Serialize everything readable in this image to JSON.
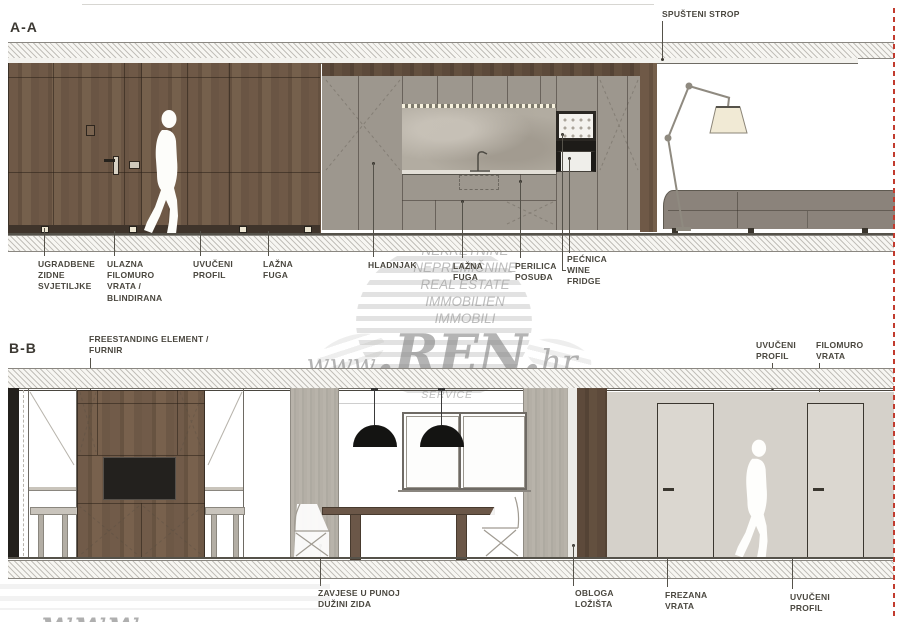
{
  "section_aa": {
    "title": "A-A",
    "ceiling_label": "SPUŠTENI STROP",
    "labels": {
      "l1": "UGRADBENE\nZIDNE\nSVJETILJKE",
      "l2": "ULAZNA\nFILOMURO\nVRATA /\nBLINDIRANA",
      "l3": "UVUČENI\nPROFIL",
      "l4": "LAŽNA\nFUGA",
      "l5": "HLADNJAK",
      "l6": "LAŽNA\nFUGA",
      "l7": "PERILICA\nPOSUĐA",
      "l8": "PEĆNICA\nWINE\nFRIDGE"
    }
  },
  "section_bb": {
    "title": "B-B",
    "labels": {
      "freestanding": "FREESTANDING ELEMENT /\nFURNIR",
      "uvuceni_profil_top": "UVUČENI\nPROFIL",
      "filomuro_vrata": "FILOMURO\nVRATA",
      "zavjese": "ZAVJESE U PUNOJ\nDUŽINI ZIDA",
      "obloga": "OBLOGA\nLOŽIŠTA",
      "frezana": "FREZANA\nVRATA",
      "uvuceni_profil_bottom": "UVUČENI\nPROFIL"
    }
  },
  "watermark": {
    "line1": "NEKRETNINE",
    "line2": "NEPREMIČNINE",
    "line3": "REAL ESTATE",
    "line4": "IMMOBILIEN",
    "line5": "IMMOBILI",
    "brand_www": "www",
    "brand_ren": ".REN.",
    "brand_hr": "hr",
    "tagline": "INVEST CONSULTING & TOURIST SERVICE",
    "corner_fragment": "www"
  },
  "colors": {
    "section_cut_red": "#c23b2e",
    "wood_brown": "#6e5847",
    "cabinet_gray": "#9d978e",
    "stone_backsplash": "#b2aca1",
    "sofa_gray": "#8b837b",
    "lamp_shade_cream": "#f1ead5",
    "curtain_gray": "#b4afa6",
    "door_wall_gray": "#d5d1ca",
    "label_text": "#4a473f",
    "watermark_gray": "#949494"
  }
}
